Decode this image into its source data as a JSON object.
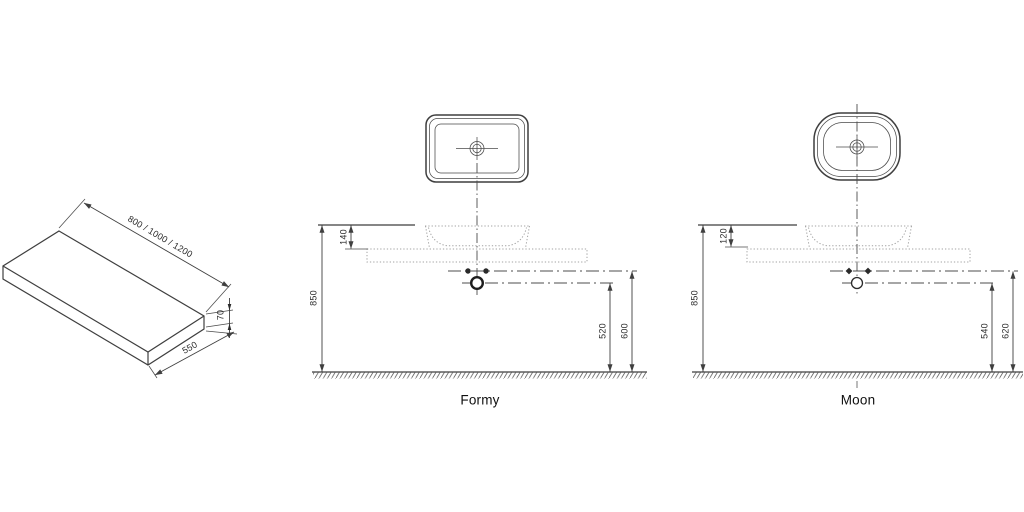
{
  "title": "Countertop washbasin installation drawing",
  "countertop": {
    "length": "800 / 1000 / 1200",
    "thickness": "70",
    "depth": "550"
  },
  "formy": {
    "label": "Formy",
    "height": "850",
    "basin_height": "140",
    "drain_height": "520",
    "supply_height": "600"
  },
  "moon": {
    "label": "Moon",
    "height": "850",
    "basin_height": "120",
    "drain_height": "540",
    "supply_height": "620"
  },
  "colors": {
    "line": "#3f3f3f",
    "dotted": "#a3a3a3",
    "text": "#2b2b2b",
    "background": "#ffffff"
  }
}
